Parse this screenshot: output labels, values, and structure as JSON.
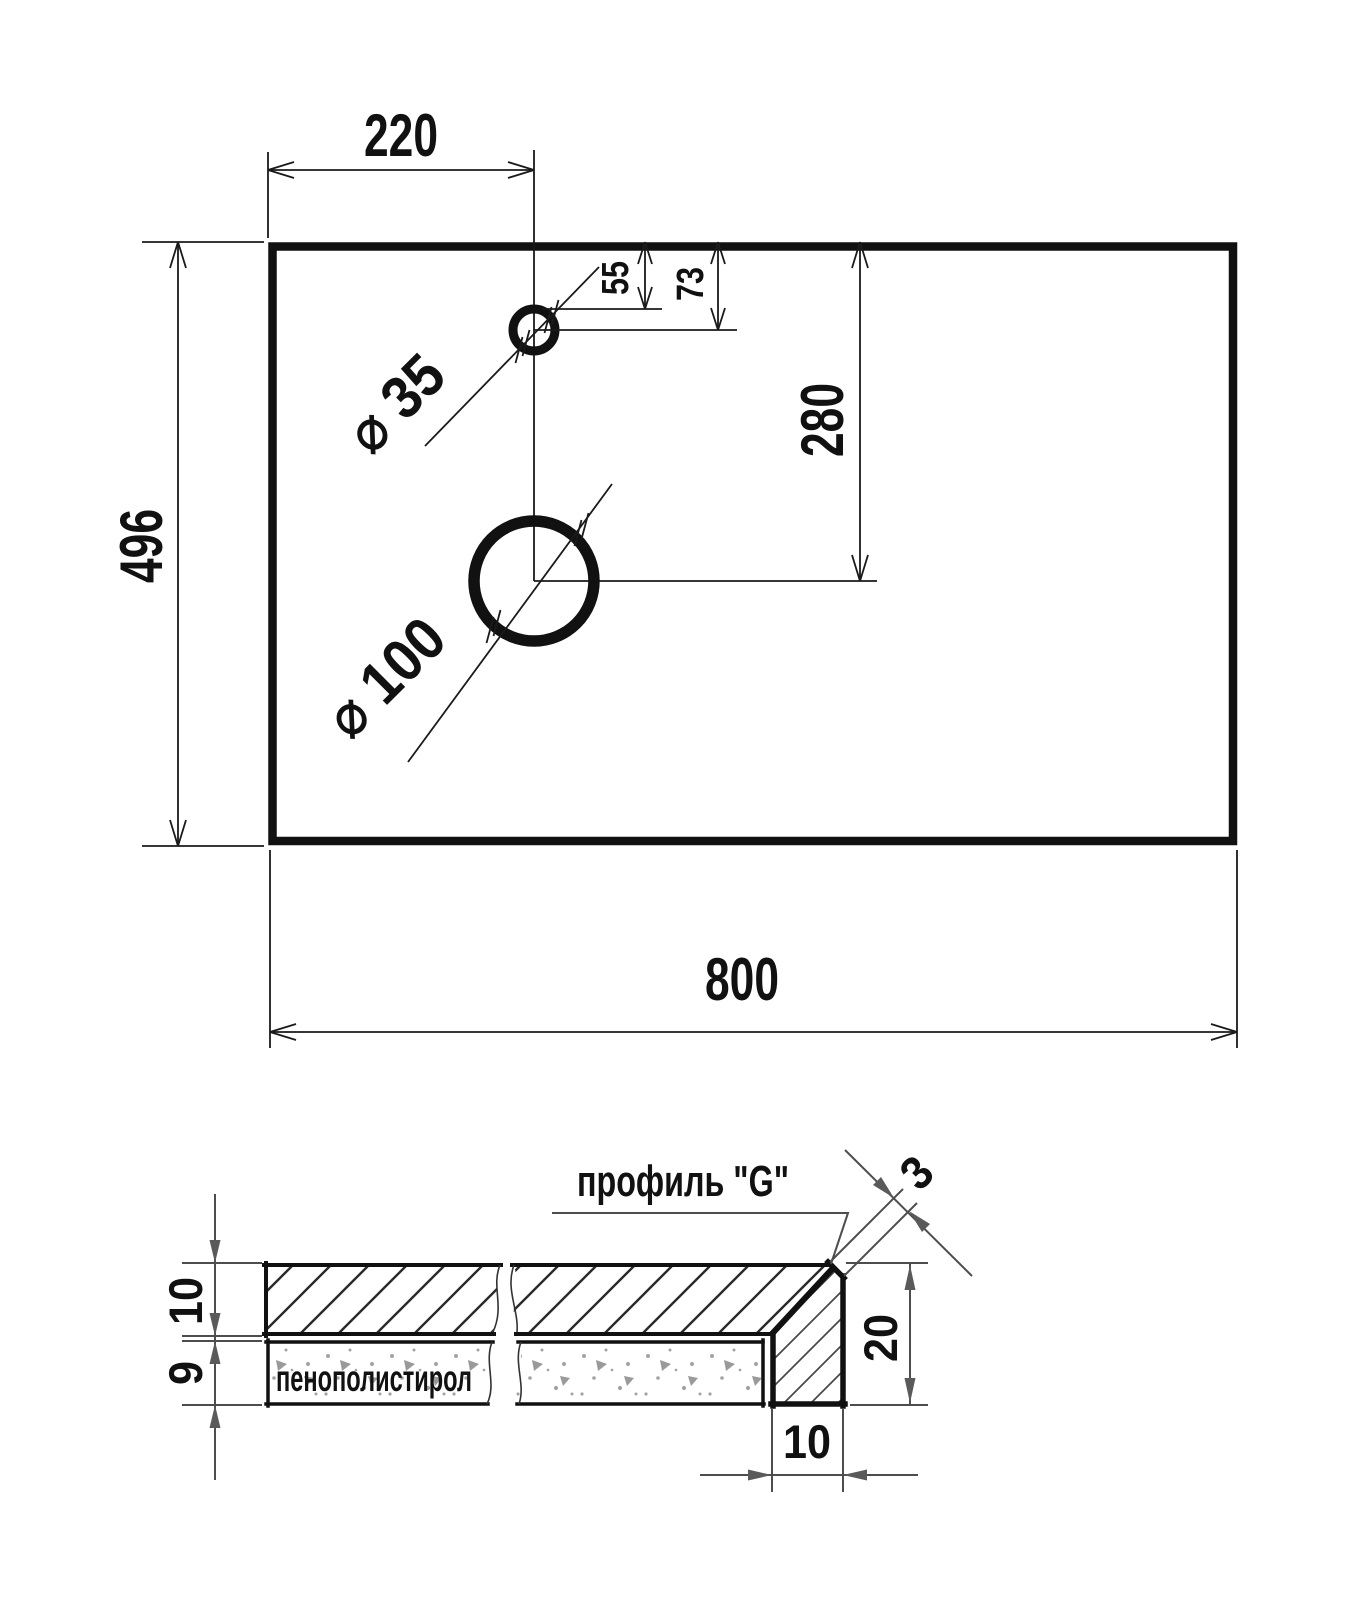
{
  "plan": {
    "width": "800",
    "height": "496",
    "hole_offset": "220",
    "hole_top_edge": "55",
    "hole_center": "73",
    "drain_center": "280",
    "faucet_dia": "⌀ 35",
    "drain_dia": "⌀ 100"
  },
  "section": {
    "profile": "профиль \"G\"",
    "foam": "пенополистирол",
    "top_thickness": "10",
    "foam_thickness": "9",
    "edge_height": "20",
    "edge_width": "10",
    "chamfer": "3"
  },
  "colors": {
    "line": "#111111",
    "dim_gray": "#4d4d4d",
    "speckle": "#9a9a9a",
    "background": "#ffffff"
  }
}
